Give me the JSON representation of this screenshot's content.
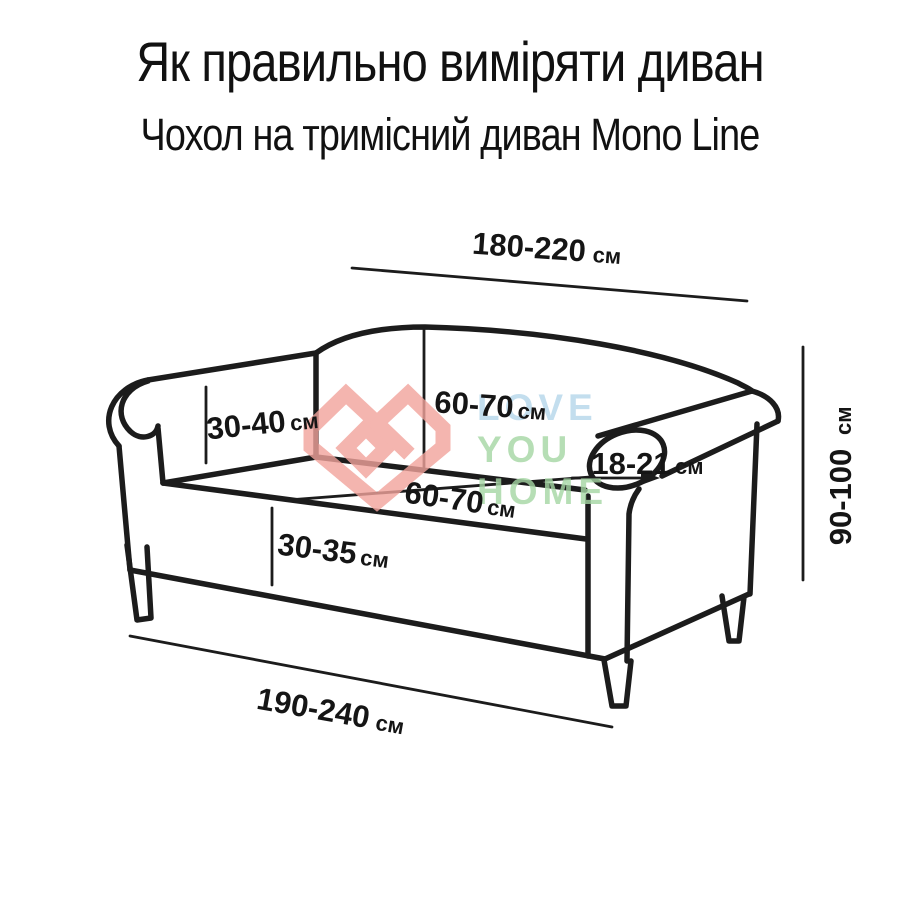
{
  "header": {
    "title": "Як правильно виміряти диван",
    "subtitle": "Чохол на тримісний диван Mono Line"
  },
  "measurements": {
    "top_width": {
      "value": "180-220",
      "unit": "см",
      "meaning": "ширина по спинці"
    },
    "arm_inner_height": {
      "value": "30-40",
      "unit": "см",
      "meaning": "висота підлокітника зсередини"
    },
    "back_height": {
      "value": "60-70",
      "unit": "см",
      "meaning": "висота спинки"
    },
    "arm_width": {
      "value": "18-21",
      "unit": "см",
      "meaning": "ширина підлокітника"
    },
    "seat_depth": {
      "value": "60-70",
      "unit": "см",
      "meaning": "глибина сидіння"
    },
    "seat_height": {
      "value": "30-35",
      "unit": "см",
      "meaning": "висота сидіння"
    },
    "total_height": {
      "value": "90-100",
      "unit": "см",
      "meaning": "загальна висота"
    },
    "bottom_width": {
      "value": "190-240",
      "unit": "см",
      "meaning": "ширина по низу"
    }
  },
  "watermark": {
    "line1": "LOVE",
    "line2": "YOU",
    "line3": "HOME",
    "heart_color": "#f2a39c",
    "love_color": "#b5d6ea",
    "you_home_color": "#a5d6a3"
  },
  "colors": {
    "background": "#ffffff",
    "line": "#1c1c1c",
    "text": "#111111"
  }
}
